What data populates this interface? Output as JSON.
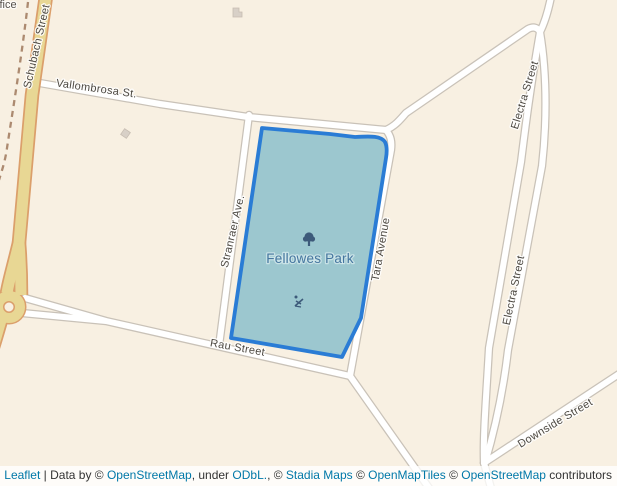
{
  "map": {
    "background_color": "#f8f0e2",
    "road_fill_color": "#ffffff",
    "road_casing_color": "#c9c2b8",
    "highway_fill_color": "#e8d794",
    "highway_casing_color": "#db9f6b",
    "path_dashed_color": "#ac8a70",
    "park": {
      "label": "Fellowes Park",
      "fill_color": "#9cc7cf",
      "outline_color": "#2a7cd5",
      "label_color": "#45769f",
      "icon_color": "#3d5a7a",
      "icons": [
        "tree-icon",
        "playground-icon"
      ]
    },
    "streets": {
      "schubach": "Schubach Street",
      "vallombrosa": "Vallombrosa St.",
      "stranraer": "Stranraer Ave.",
      "tara": "Tara Avenue",
      "electra": "Electra Street",
      "rau": "Rau Street",
      "downside": "Downside Street"
    },
    "clipped_poi_label": "fice"
  },
  "attribution": {
    "segments": [
      {
        "text": "Leaflet",
        "link": true
      },
      {
        "text": " | Data by © ",
        "link": false
      },
      {
        "text": "OpenStreetMap",
        "link": true
      },
      {
        "text": ", under ",
        "link": false
      },
      {
        "text": "ODbL.",
        "link": true
      },
      {
        "text": ", © ",
        "link": false
      },
      {
        "text": "Stadia Maps",
        "link": true
      },
      {
        "text": " © ",
        "link": false
      },
      {
        "text": "OpenMapTiles",
        "link": true
      },
      {
        "text": " © ",
        "link": false
      },
      {
        "text": "OpenStreetMap",
        "link": true
      },
      {
        "text": " contributors",
        "link": false
      }
    ],
    "link_color": "#0078a8"
  }
}
